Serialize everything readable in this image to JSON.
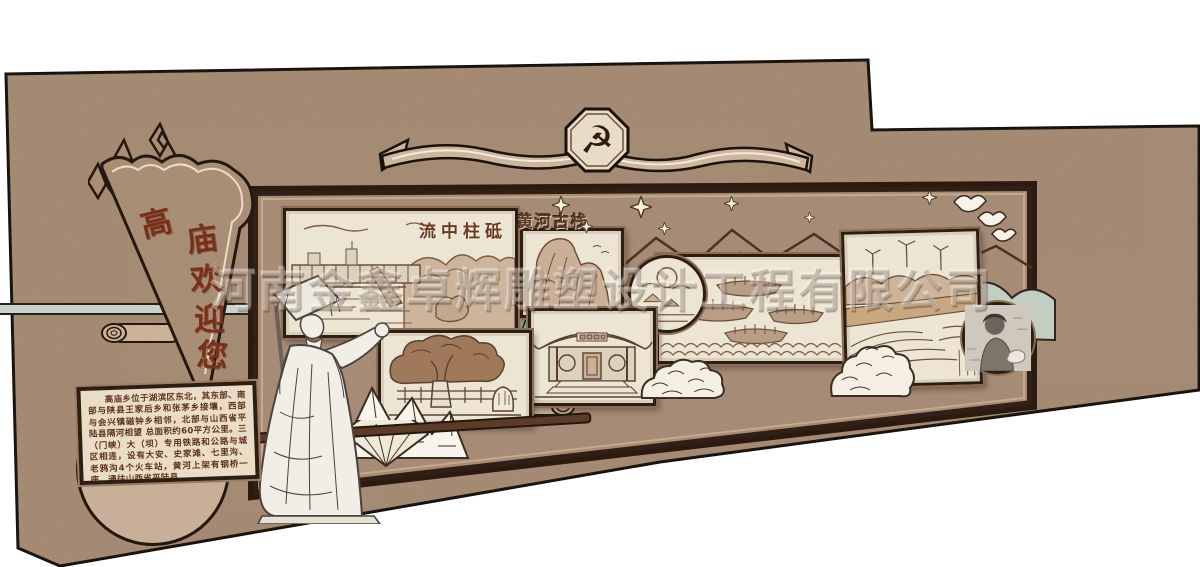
{
  "scene": {
    "description_label": "cultural wall design rendering"
  },
  "watermark": {
    "text": "河南金鑫卓辉雕塑设计工程有限公司"
  },
  "flag": {
    "label": "高庙欢迎您",
    "chars": [
      "高",
      "庙",
      "欢",
      "迎",
      "您"
    ]
  },
  "icons": {
    "party_emblem": "☭"
  },
  "panels": {
    "dam": {
      "title": "流中柱砥"
    },
    "cliff": {
      "title": "黄河古栈"
    }
  },
  "plaque": {
    "text": "高庙乡位于湖滨区东北，其东部、南部与陕县王家后乡和张茅乡接壤，西部与会兴镇磁钟乡相邻，北部与山西省平陆县隔河相望 总面积约60平方公里。三（门峡）大（坝）专用铁路和公路与城区相连，设有大安、史家滩、七里沟、老鸦沟4个火车站，黄河上架有钢桥一座，通往山西省平陆县。"
  },
  "colors": {
    "wall": "#a68c74",
    "board": "#a88d77",
    "frame": "#2e1d12",
    "panel_bg": "#ece5d3",
    "ink": "#7b5b44",
    "brush_red": "#7a3018",
    "ribbon_cream": "#cdb69e",
    "teal": "#9fb5a8"
  }
}
